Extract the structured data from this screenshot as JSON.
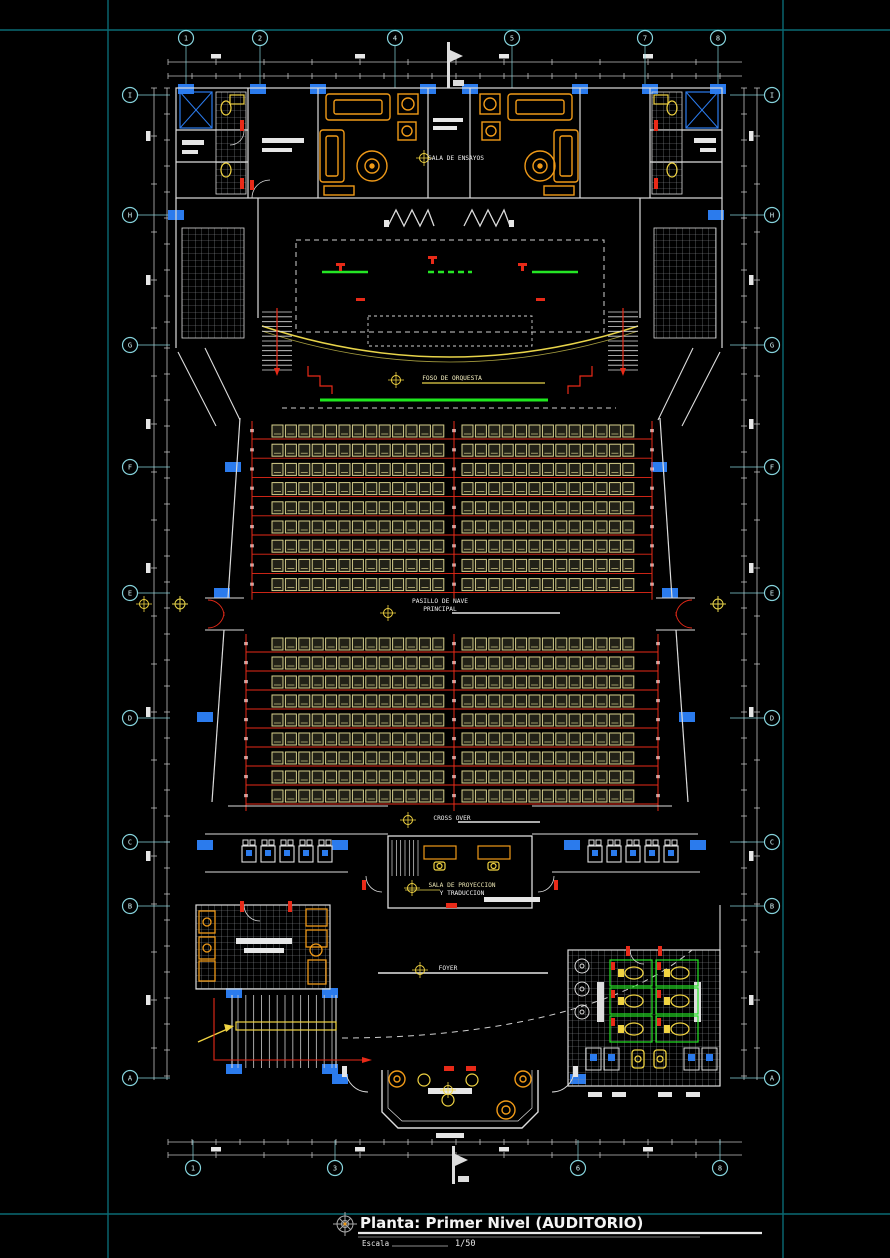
{
  "drawing": {
    "title": "Planta: Primer Nivel (AUDITORIO)",
    "scale_label": "Escala",
    "scale_value": "1/50",
    "rooms": {
      "sala_ensayos": "SALA DE ENSAYOS",
      "foso_orquesta": "FOSO DE ORQUESTA",
      "pasillo_line1": "PASILLO DE NAVE",
      "pasillo_line2": "PRINCIPAL",
      "cross_over": "CROSS OVER",
      "proyeccion_line1": "SALA DE PROYECCION",
      "proyeccion_line2": "Y TRADUCCION",
      "foyer": "FOYER"
    },
    "grid": {
      "top": [
        {
          "label": "1",
          "x": 186
        },
        {
          "label": "2",
          "x": 260
        },
        {
          "label": "4",
          "x": 395
        },
        {
          "label": "5",
          "x": 512
        },
        {
          "label": "7",
          "x": 645
        },
        {
          "label": "8",
          "x": 718
        }
      ],
      "bottom": [
        {
          "label": "1",
          "x": 193
        },
        {
          "label": "3",
          "x": 335
        },
        {
          "label": "6",
          "x": 578
        },
        {
          "label": "8",
          "x": 720
        }
      ],
      "left": [
        {
          "label": "I",
          "y": 95
        },
        {
          "label": "H",
          "y": 215
        },
        {
          "label": "G",
          "y": 345
        },
        {
          "label": "F",
          "y": 467
        },
        {
          "label": "E",
          "y": 593
        },
        {
          "label": "D",
          "y": 718
        },
        {
          "label": "C",
          "y": 842
        },
        {
          "label": "B",
          "y": 906
        },
        {
          "label": "A",
          "y": 1078
        }
      ],
      "right": [
        {
          "label": "I",
          "y": 95
        },
        {
          "label": "H",
          "y": 215
        },
        {
          "label": "G",
          "y": 345
        },
        {
          "label": "F",
          "y": 467
        },
        {
          "label": "E",
          "y": 593
        },
        {
          "label": "D",
          "y": 718
        },
        {
          "label": "C",
          "y": 842
        },
        {
          "label": "B",
          "y": 906
        },
        {
          "label": "A",
          "y": 1078
        }
      ]
    },
    "seating": {
      "blocks": [
        {
          "yTop": 425,
          "rows": 9,
          "rowPitch": 19.2,
          "seatW": 11,
          "seatH": 12,
          "seatPitch": 13.4,
          "sections": [
            {
              "x": 272,
              "seats": 13
            },
            {
              "x": 462,
              "seats": 13
            }
          ],
          "aisleXs": [
            252,
            454,
            652
          ],
          "walls": {
            "lx1": 240,
            "lx2": 228,
            "rx1": 660,
            "rx2": 672,
            "y1": 418,
            "y2": 598
          }
        },
        {
          "yTop": 638,
          "rows": 9,
          "rowPitch": 19.0,
          "seatW": 11,
          "seatH": 12,
          "seatPitch": 13.4,
          "sections": [
            {
              "x": 272,
              "seats": 13
            },
            {
              "x": 462,
              "seats": 13
            }
          ],
          "aisleXs": [
            246,
            454,
            658
          ],
          "walls": {
            "lx1": 224,
            "lx2": 212,
            "rx1": 676,
            "rx2": 688,
            "y1": 630,
            "y2": 802
          }
        }
      ]
    },
    "fixtures": {
      "makeup_chairs_left": 5,
      "makeup_chairs_right": 5,
      "wc_stalls": 6,
      "wc_sink_circles": 3
    },
    "colors": {
      "background": "#000000",
      "frame_teal": "#0a6a74",
      "bubble_stroke": "#86d3dc",
      "bubble_text": "#d2f0f4",
      "wall_white": "#dcdcdc",
      "dim_gray": "#c0c0c0",
      "red": "#e82a18",
      "yellow": "#f0d342",
      "orange": "#f09a18",
      "seat_khaki": "#d6cf8c",
      "green": "#25e625",
      "column_blue": "#2b7bed",
      "hatch_gray": "#8d9296"
    }
  }
}
